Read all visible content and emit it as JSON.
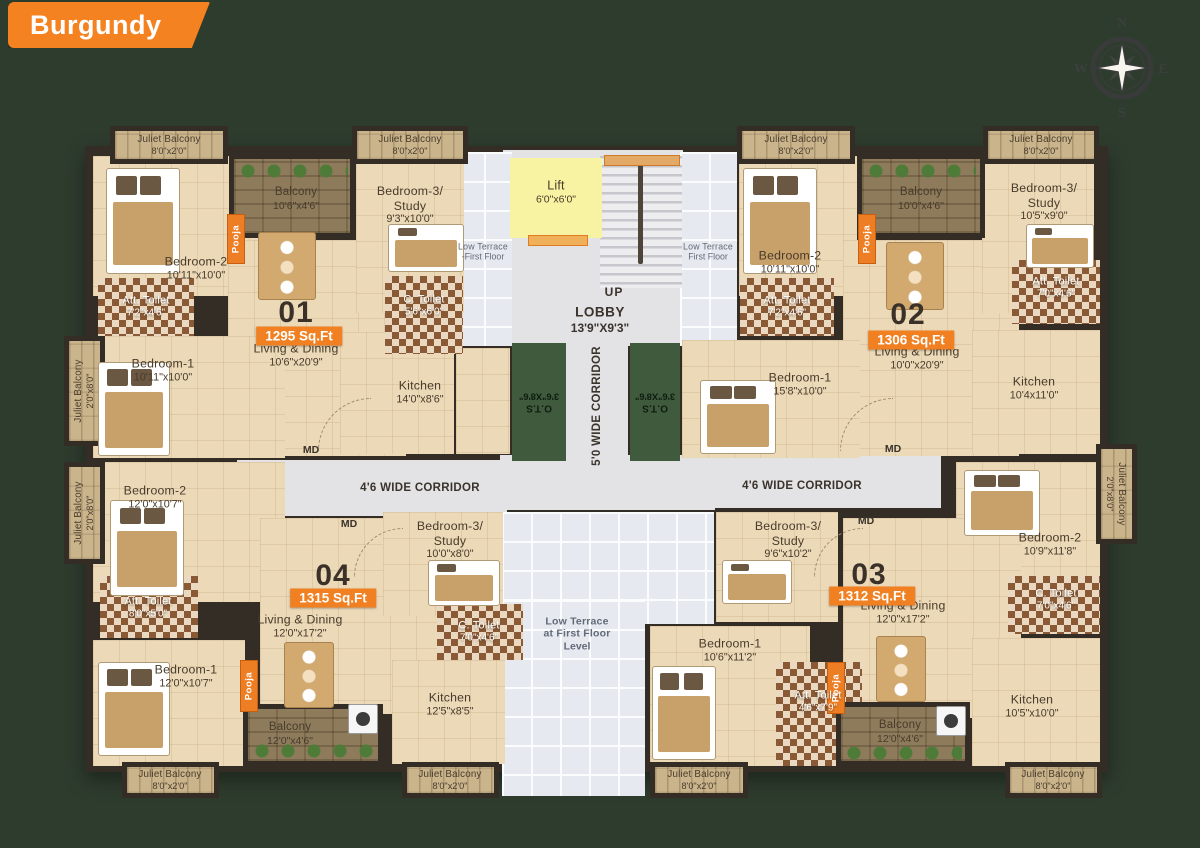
{
  "header": {
    "title": "Burgundy"
  },
  "compass": {
    "north": "N",
    "east": "E",
    "south": "S",
    "west": "W"
  },
  "colors": {
    "background": "#2e3c2e",
    "banner_orange": "#f58220",
    "wall": "#332d26",
    "floor_beige": "#ecd9b8",
    "lift_yellow": "#f8f2a3",
    "ots_green": "#3f5a3c",
    "terrace_gray": "#e6e9ef",
    "corridor_gray": "#e3e3e6",
    "badge_orange": "#f08021"
  },
  "units": [
    {
      "number": "01",
      "area": "1295 Sq.Ft",
      "num_at": [
        296,
        313
      ],
      "badge_at": [
        299,
        336
      ]
    },
    {
      "number": "02",
      "area": "1306 Sq.Ft",
      "num_at": [
        908,
        315
      ],
      "badge_at": [
        911,
        340
      ]
    },
    {
      "number": "03",
      "area": "1312 Sq.Ft",
      "num_at": [
        869,
        575
      ],
      "badge_at": [
        872,
        596
      ]
    },
    {
      "number": "04",
      "area": "1315 Sq.Ft",
      "num_at": [
        333,
        576
      ],
      "badge_at": [
        333,
        598
      ]
    }
  ],
  "rooms": [
    {
      "n": "core-lobby-area",
      "t": "gray",
      "b": [
        503,
        150,
        180,
        196
      ]
    },
    {
      "n": "corridor-5ft",
      "t": "gray",
      "b": [
        566,
        345,
        62,
        124
      ]
    },
    {
      "n": "corridor-junction",
      "t": "gray",
      "b": [
        500,
        455,
        215,
        55
      ]
    },
    {
      "n": "corridor-left-band",
      "t": "gray",
      "b": [
        237,
        460,
        270,
        56
      ]
    },
    {
      "n": "corridor-right-band",
      "t": "gray",
      "b": [
        636,
        456,
        305,
        52
      ]
    },
    {
      "n": "low-terrace-left",
      "t": "terrace",
      "b": [
        455,
        152,
        57,
        194
      ],
      "lines": [
        "Low Terrace",
        "-First Floor"
      ],
      "la": [
        483,
        252
      ],
      "sm": true
    },
    {
      "n": "low-terrace-right",
      "t": "terrace",
      "b": [
        680,
        152,
        57,
        194
      ],
      "lines": [
        "Low Terrace",
        "First Floor"
      ],
      "la": [
        708,
        252
      ],
      "sm": true
    },
    {
      "n": "low-terrace-bottom-upper",
      "t": "terrace",
      "b": [
        502,
        512,
        212,
        112
      ]
    },
    {
      "n": "low-terrace-bottom",
      "t": "terrace",
      "b": [
        502,
        600,
        143,
        196
      ],
      "lines": [
        "Low Terrace",
        "at First Floor",
        "Level"
      ],
      "la": [
        577,
        634
      ]
    },
    {
      "n": "stairs",
      "t": "stairs",
      "b": [
        600,
        156,
        82,
        132
      ]
    },
    {
      "n": "lift",
      "t": "lift",
      "b": [
        510,
        158,
        92,
        80
      ],
      "lines": [
        "Lift",
        "6'0\"x6'0\""
      ],
      "la": [
        556,
        192
      ]
    },
    {
      "n": "u01-bedroom-2",
      "t": "room",
      "b": [
        93,
        156,
        214,
        140
      ],
      "lines": [
        "Bedroom-2",
        "10'11\"x10'0\""
      ],
      "la": [
        196,
        268
      ]
    },
    {
      "n": "u01-living-dining",
      "t": "room",
      "b": [
        228,
        240,
        178,
        216
      ],
      "lines": [
        "Living & Dining",
        "10'6\"x20'9\""
      ],
      "la": [
        296,
        355
      ]
    },
    {
      "n": "u01-bedroom-1",
      "t": "room",
      "b": [
        93,
        336,
        192,
        122
      ],
      "lines": [
        "Bedroom-1",
        "10'11\"x10'0\""
      ],
      "la": [
        163,
        370
      ]
    },
    {
      "n": "u01-bedroom-3",
      "t": "room",
      "b": [
        356,
        163,
        108,
        150
      ],
      "lines": [
        "Bedroom-3/",
        "Study",
        "9'3\"x10'0\""
      ],
      "la": [
        410,
        205
      ]
    },
    {
      "n": "u01-kitchen",
      "t": "room",
      "b": [
        340,
        332,
        114,
        122
      ],
      "lines": [
        "Kitchen",
        "14'0\"x8'6\""
      ],
      "la": [
        420,
        392
      ]
    },
    {
      "n": "u01-utility",
      "t": "room",
      "b": [
        456,
        348,
        54,
        106
      ]
    },
    {
      "n": "u01-att-toilet",
      "t": "toilet",
      "b": [
        98,
        278,
        96,
        58
      ],
      "lines": [
        "Att. Toilet",
        "7'2\"x4'6\""
      ],
      "la": [
        146,
        307
      ]
    },
    {
      "n": "u01-c-toilet",
      "t": "toilet",
      "b": [
        385,
        276,
        78,
        78
      ],
      "lines": [
        "C. Toilet",
        "5'6\"x6'0\""
      ],
      "la": [
        424,
        306
      ]
    },
    {
      "n": "u01-balcony",
      "t": "balcony",
      "b": [
        229,
        154,
        126,
        84
      ],
      "lines": [
        "Balcony",
        "10'6\"x4'6\""
      ],
      "la": [
        296,
        199
      ]
    },
    {
      "n": "u01-pooja",
      "t": "pooja",
      "b": [
        227,
        214,
        18,
        50
      ],
      "lines": [
        "Pooja"
      ],
      "la": [
        236,
        239
      ]
    },
    {
      "n": "u02-bedroom-2",
      "t": "room",
      "b": [
        739,
        156,
        118,
        140
      ],
      "lines": [
        "Bedroom-2",
        "10'11\"x10'0\""
      ],
      "la": [
        790,
        262
      ]
    },
    {
      "n": "u02-living-dining",
      "t": "room",
      "b": [
        843,
        240,
        176,
        216
      ],
      "lines": [
        "Living & Dining",
        "10'0\"x20'9\""
      ],
      "la": [
        917,
        358
      ]
    },
    {
      "n": "u02-bedroom-1",
      "t": "room",
      "b": [
        682,
        340,
        178,
        118
      ],
      "lines": [
        "Bedroom-1",
        "15'8\"x10'0\""
      ],
      "la": [
        800,
        384
      ]
    },
    {
      "n": "u02-bedroom-3",
      "t": "room",
      "b": [
        982,
        163,
        112,
        150
      ],
      "lines": [
        "Bedroom-3/",
        "Study",
        "10'5\"x9'0\""
      ],
      "la": [
        1044,
        202
      ]
    },
    {
      "n": "u02-kitchen",
      "t": "room",
      "b": [
        972,
        330,
        128,
        124
      ],
      "lines": [
        "Kitchen",
        "10'4x11'0\""
      ],
      "la": [
        1034,
        388
      ]
    },
    {
      "n": "u02-att-toilet-1",
      "t": "toilet",
      "b": [
        740,
        278,
        94,
        58
      ],
      "lines": [
        "Att. Toilet",
        "7'2\"x4'6\""
      ],
      "la": [
        787,
        307
      ]
    },
    {
      "n": "u02-att-toilet-2",
      "t": "toilet",
      "b": [
        1012,
        260,
        88,
        64
      ],
      "lines": [
        "Att. Toilet",
        "7'0\"x4'6\""
      ],
      "la": [
        1056,
        288
      ]
    },
    {
      "n": "u02-balcony",
      "t": "balcony",
      "b": [
        857,
        154,
        128,
        84
      ],
      "lines": [
        "Balcony",
        "10'0\"x4'6\""
      ],
      "la": [
        921,
        199
      ]
    },
    {
      "n": "u02-pooja",
      "t": "pooja",
      "b": [
        858,
        214,
        18,
        50
      ],
      "lines": [
        "Pooja"
      ],
      "la": [
        867,
        239
      ]
    },
    {
      "n": "u04-bedroom-2",
      "t": "room",
      "b": [
        93,
        462,
        192,
        140
      ],
      "lines": [
        "Bedroom-2",
        "12'0\"x10'7\""
      ],
      "la": [
        155,
        497
      ]
    },
    {
      "n": "u04-living-dining",
      "t": "room",
      "b": [
        260,
        518,
        188,
        196
      ],
      "lines": [
        "Living & Dining",
        "12'0\"x17'2\""
      ],
      "la": [
        300,
        626
      ]
    },
    {
      "n": "u04-bedroom-1",
      "t": "room",
      "b": [
        93,
        640,
        152,
        126
      ],
      "lines": [
        "Bedroom-1",
        "12'0\"x10'7\""
      ],
      "la": [
        186,
        676
      ]
    },
    {
      "n": "u04-bedroom-3",
      "t": "room",
      "b": [
        383,
        512,
        120,
        104
      ],
      "lines": [
        "Bedroom-3/",
        "Study",
        "10'0\"x8'0\""
      ],
      "la": [
        450,
        540
      ]
    },
    {
      "n": "u04-kitchen",
      "t": "room",
      "b": [
        392,
        660,
        113,
        104
      ],
      "lines": [
        "Kitchen",
        "12'5\"x8'5\""
      ],
      "la": [
        450,
        704
      ]
    },
    {
      "n": "u04-att-toilet",
      "t": "toilet",
      "b": [
        100,
        576,
        98,
        62
      ],
      "lines": [
        "Att. Toilet",
        "8'0\"x5'0\""
      ],
      "la": [
        148,
        608
      ]
    },
    {
      "n": "u04-c-toilet",
      "t": "toilet",
      "b": [
        437,
        604,
        86,
        56
      ],
      "lines": [
        "C. Toilet",
        "7'0\"x4'6\""
      ],
      "la": [
        479,
        632
      ]
    },
    {
      "n": "u04-balcony",
      "t": "balcony",
      "b": [
        243,
        704,
        140,
        62
      ],
      "lines": [
        "Balcony",
        "12'0\"x4'6\""
      ],
      "la": [
        290,
        734
      ]
    },
    {
      "n": "u04-pooja",
      "t": "pooja",
      "b": [
        240,
        660,
        18,
        52
      ],
      "lines": [
        "Pooja"
      ],
      "la": [
        249,
        686
      ]
    },
    {
      "n": "u03-bedroom-2",
      "t": "room",
      "b": [
        956,
        462,
        144,
        118
      ],
      "lines": [
        "Bedroom-2",
        "10'9\"x11'8\""
      ],
      "la": [
        1050,
        544
      ]
    },
    {
      "n": "u03-living-dining",
      "t": "room",
      "b": [
        843,
        518,
        178,
        200
      ],
      "lines": [
        "Living & Dining",
        "12'0\"x17'2\""
      ],
      "la": [
        903,
        612
      ]
    },
    {
      "n": "u03-bedroom-1",
      "t": "room",
      "b": [
        650,
        626,
        160,
        140
      ],
      "lines": [
        "Bedroom-1",
        "10'6\"x11'2\""
      ],
      "la": [
        730,
        650
      ]
    },
    {
      "n": "u03-bedroom-3",
      "t": "room",
      "b": [
        716,
        512,
        122,
        110
      ],
      "lines": [
        "Bedroom-3/",
        "Study",
        "9'6\"x10'2\""
      ],
      "la": [
        788,
        540
      ]
    },
    {
      "n": "u03-kitchen",
      "t": "room",
      "b": [
        972,
        638,
        128,
        128
      ],
      "lines": [
        "Kitchen",
        "10'5\"x10'0\""
      ],
      "la": [
        1032,
        706
      ]
    },
    {
      "n": "u03-att-toilet",
      "t": "toilet",
      "b": [
        776,
        662,
        86,
        104
      ],
      "lines": [
        "Att. Toilet",
        "4'6\"x7'9\""
      ],
      "la": [
        818,
        702
      ]
    },
    {
      "n": "u03-c-toilet",
      "t": "toilet",
      "b": [
        1008,
        576,
        92,
        58
      ],
      "lines": [
        "C. Toilet",
        "7'0\"x4'6\""
      ],
      "la": [
        1056,
        600
      ]
    },
    {
      "n": "u03-balcony",
      "t": "balcony",
      "b": [
        836,
        702,
        134,
        64
      ],
      "lines": [
        "Balcony",
        "12'0\"x4'6\""
      ],
      "la": [
        900,
        732
      ]
    },
    {
      "n": "u03-pooja",
      "t": "pooja",
      "b": [
        827,
        662,
        18,
        52
      ],
      "lines": [
        "Pooja"
      ],
      "la": [
        836,
        688
      ]
    },
    {
      "n": "ots-left",
      "t": "ots",
      "b": [
        512,
        343,
        54,
        118
      ],
      "lines": [
        "O.T.S",
        "3'6\"X8'6\""
      ],
      "la": [
        539,
        402
      ]
    },
    {
      "n": "ots-right",
      "t": "ots",
      "b": [
        630,
        343,
        50,
        118
      ],
      "lines": [
        "O.T.S",
        "3'6\"X8'6\""
      ],
      "la": [
        655,
        402
      ]
    },
    {
      "n": "juliet-balcony-top-1",
      "t": "juliet",
      "b": [
        110,
        126,
        118,
        38
      ],
      "lines": [
        "Juliet Balcony",
        "8'0\"x2'0\""
      ],
      "la": [
        169,
        145
      ]
    },
    {
      "n": "juliet-balcony-top-2",
      "t": "juliet",
      "b": [
        352,
        126,
        116,
        38
      ],
      "lines": [
        "Juliet Balcony",
        "8'0\"x2'0\""
      ],
      "la": [
        410,
        145
      ]
    },
    {
      "n": "juliet-balcony-top-3",
      "t": "juliet",
      "b": [
        737,
        126,
        118,
        38
      ],
      "lines": [
        "Juliet Balcony",
        "8'0\"x2'0\""
      ],
      "la": [
        796,
        145
      ]
    },
    {
      "n": "juliet-balcony-top-4",
      "t": "juliet",
      "b": [
        983,
        126,
        116,
        38
      ],
      "lines": [
        "Juliet Balcony",
        "8'0\"x2'0\""
      ],
      "la": [
        1041,
        145
      ]
    },
    {
      "n": "juliet-balcony-bottom-1",
      "t": "juliet",
      "b": [
        122,
        762,
        97,
        36
      ],
      "lines": [
        "Juliet Balcony",
        "8'0\"x2'0\""
      ],
      "la": [
        170,
        780
      ]
    },
    {
      "n": "juliet-balcony-bottom-2",
      "t": "juliet",
      "b": [
        402,
        762,
        97,
        36
      ],
      "lines": [
        "Juliet Balcony",
        "8'0\"x2'0\""
      ],
      "la": [
        450,
        780
      ]
    },
    {
      "n": "juliet-balcony-bottom-3",
      "t": "juliet",
      "b": [
        650,
        762,
        98,
        36
      ],
      "lines": [
        "Juliet Balcony",
        "8'0\"x2'0\""
      ],
      "la": [
        699,
        780
      ]
    },
    {
      "n": "juliet-balcony-bottom-4",
      "t": "juliet",
      "b": [
        1005,
        762,
        97,
        36
      ],
      "lines": [
        "Juliet Balcony",
        "8'0\"x2'0\""
      ],
      "la": [
        1053,
        780
      ]
    },
    {
      "n": "juliet-balcony-left-1",
      "t": "juliet-v",
      "b": [
        64,
        336,
        41,
        110
      ],
      "lines": [
        "Juliet Balcony",
        "2'0\"x8'0\""
      ],
      "la": [
        84,
        391
      ],
      "rot": -90
    },
    {
      "n": "juliet-balcony-left-2",
      "t": "juliet-v",
      "b": [
        64,
        462,
        41,
        102
      ],
      "lines": [
        "Juliet Balcony",
        "2'0\"x8'0\""
      ],
      "la": [
        84,
        513
      ],
      "rot": -90
    },
    {
      "n": "juliet-balcony-right-1",
      "t": "juliet-v",
      "b": [
        1096,
        444,
        41,
        100
      ],
      "lines": [
        "Juliet Balcony",
        "2'0\"x8'0\""
      ],
      "la": [
        1116,
        494
      ],
      "rot": 90
    }
  ],
  "texts": [
    {
      "n": "u01-md-label",
      "s": "MD",
      "at": [
        311,
        450
      ],
      "c": "md"
    },
    {
      "n": "u02-md-label",
      "s": "MD",
      "at": [
        893,
        449
      ],
      "c": "md"
    },
    {
      "n": "u04-md-label",
      "s": "MD",
      "at": [
        349,
        524
      ],
      "c": "md"
    },
    {
      "n": "u03-md-label",
      "s": "MD",
      "at": [
        866,
        521
      ],
      "c": "md"
    },
    {
      "n": "stairs-up-label",
      "s": "UP",
      "at": [
        614,
        292
      ],
      "c": "up"
    },
    {
      "n": "lobby-label",
      "s": "LOBBY",
      "at": [
        600,
        312
      ],
      "c": "lobby"
    },
    {
      "n": "lobby-dims",
      "s": "13'9\"X9'3\"",
      "at": [
        600,
        328
      ],
      "c": "lobbyd"
    },
    {
      "n": "corridor-left-label",
      "s": "4'6 WIDE CORRIDOR",
      "at": [
        420,
        488
      ],
      "c": "corr"
    },
    {
      "n": "corridor-right-label",
      "s": "4'6 WIDE CORRIDOR",
      "at": [
        802,
        486
      ],
      "c": "corr"
    },
    {
      "n": "corridor-vertical-label",
      "s": "5'0 WIDE CORRIDOR",
      "at": [
        597,
        406
      ],
      "c": "corr vert"
    }
  ]
}
